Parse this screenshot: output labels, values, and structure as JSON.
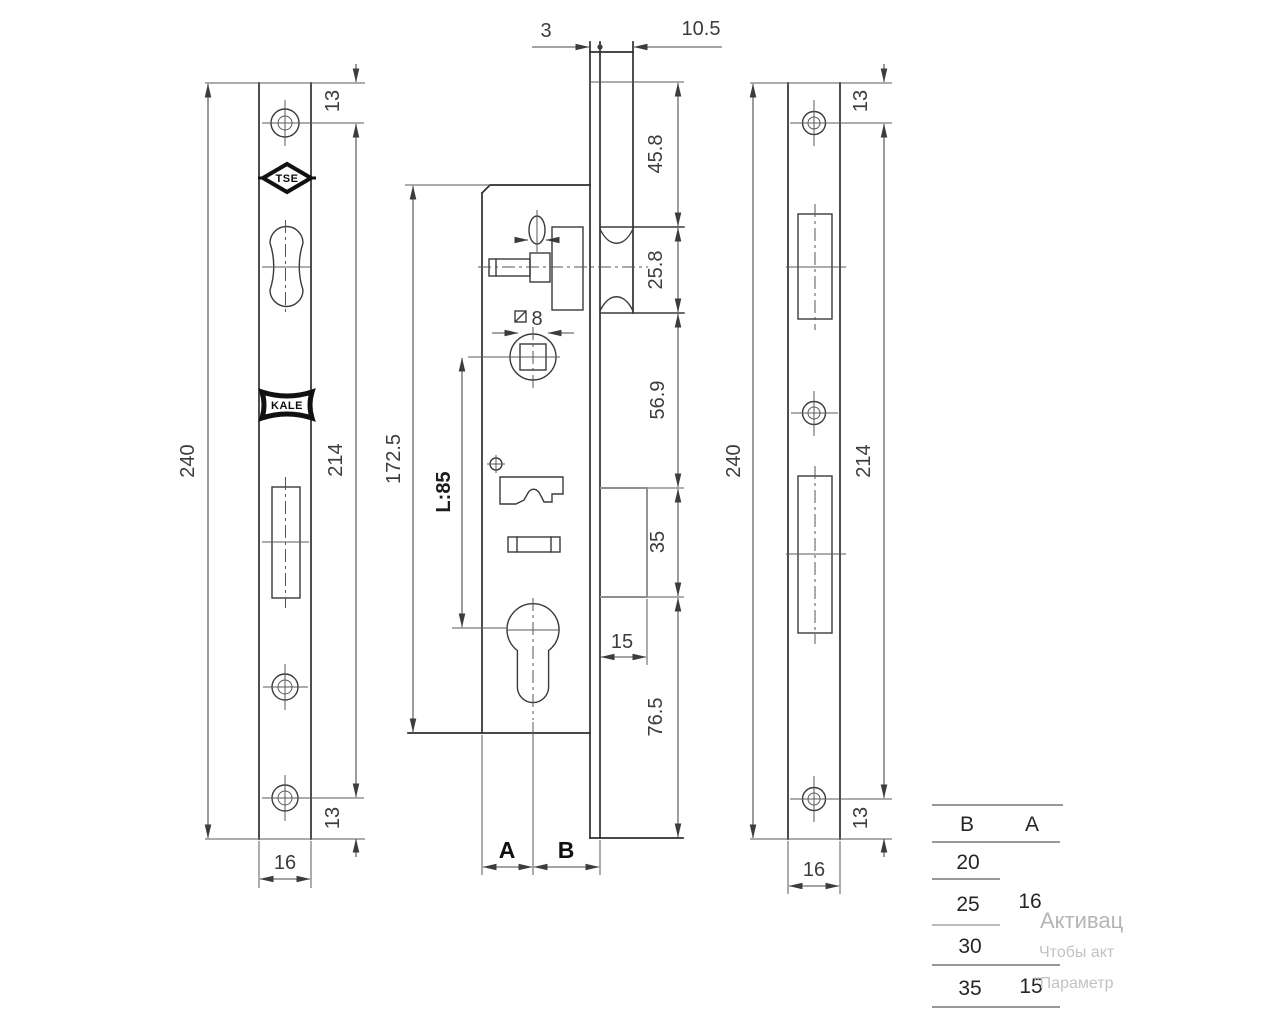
{
  "left_view": {
    "overall_length": "240",
    "hole_spacing": "214",
    "hole_offset_top": "13",
    "hole_offset_bottom": "13",
    "width": "16",
    "tse_logo": "TSE",
    "kale_logo": "KALE"
  },
  "middle_view": {
    "faceplate_thickness": "3",
    "profile_depth": "10.5",
    "top_to_latch": "45.8",
    "latch_height": "25.8",
    "latch_to_bolt": "56.9",
    "bolt_height": "35",
    "bolt_throw": "15",
    "bolt_to_bottom": "76.5",
    "case_length": "172.5",
    "centre_distance": "L:85",
    "spindle_square": "8",
    "backset_label_a": "A",
    "backset_label_b": "B"
  },
  "right_view": {
    "overall_length": "240",
    "hole_spacing": "214",
    "hole_offset_top": "13",
    "hole_offset_bottom": "13",
    "width": "16"
  },
  "size_table": {
    "header_b": "B",
    "header_a": "A",
    "b_values": [
      "20",
      "25",
      "30",
      "35"
    ],
    "a_value_top": "16",
    "a_value_bottom": "15"
  },
  "watermark": {
    "line1": "Активац",
    "line2": "Чтобы акт",
    "line3": "\"Параметр"
  }
}
